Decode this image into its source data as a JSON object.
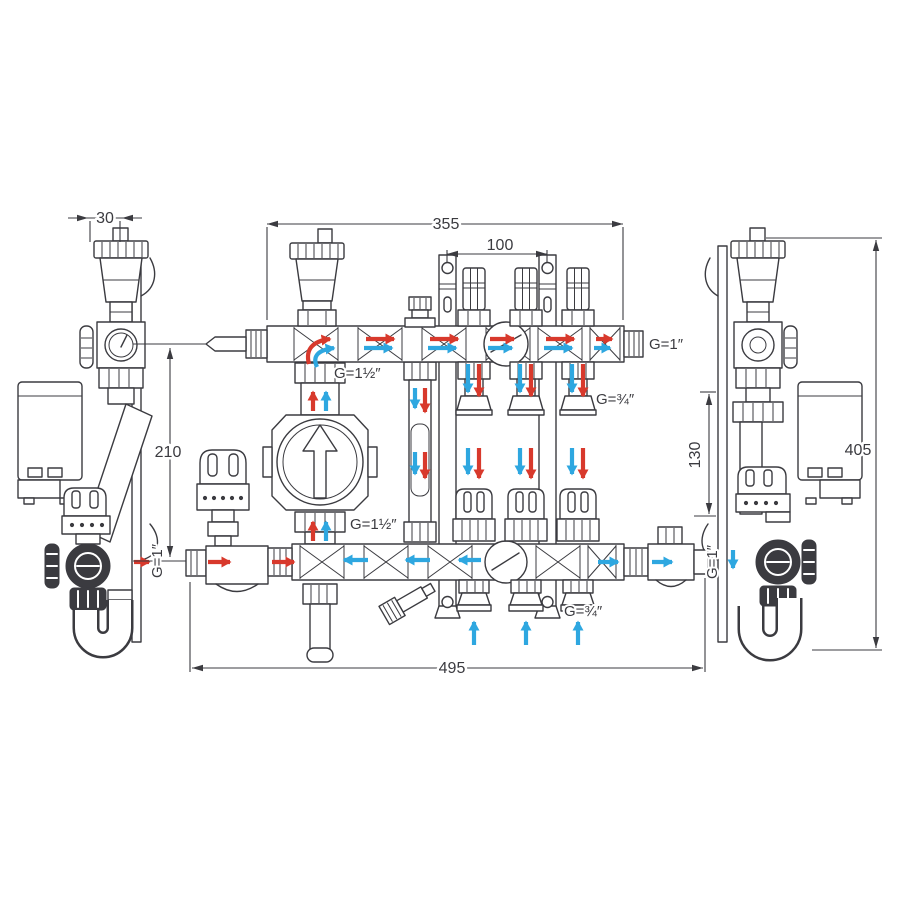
{
  "colors": {
    "line": "#3b3b40",
    "supply": "#d8392c",
    "return": "#2ea7e0",
    "background": "#ffffff"
  },
  "dimensions": {
    "bracket_depth": "30",
    "manifold_length": "355",
    "bracket_spacing": "100",
    "axis_spacing": "210",
    "return_drop": "130",
    "overall_height": "405",
    "overall_width": "495"
  },
  "labels": {
    "top_manifold_end": "G=1″",
    "pump_union_top": "G=1½″",
    "pump_union_bottom": "G=1½″",
    "loop_supply": "G=¾″",
    "loop_return": "G=¾″",
    "primary_supply_inlet": "G=1″",
    "primary_return_outlet": "G=1″"
  }
}
